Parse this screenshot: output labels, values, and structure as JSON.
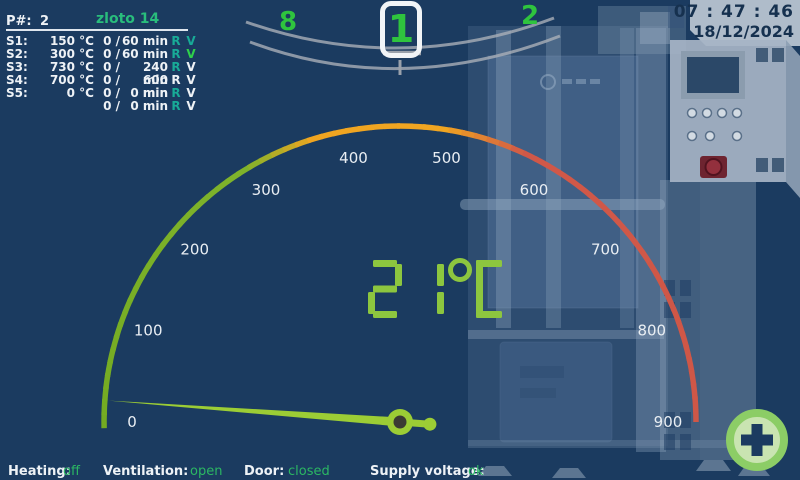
{
  "colors": {
    "background": "#1b3b60",
    "selector_green": "#2fc43e",
    "display_green": "#8dc63f",
    "needle_green": "#9ccd35",
    "needle_hub_dark": "#3b3b33",
    "tick_white": "#e9eef3",
    "clock_navy": "#16314f",
    "status_value_green": "#2bb763",
    "states": {
      "teal": "#18ab97",
      "green": "#2fd14b",
      "white": "#eef2f6"
    }
  },
  "program": {
    "number_label": "P#:",
    "number": "2",
    "name": "zloto 14",
    "r_label": "R",
    "v_label": "V",
    "segments": [
      {
        "id": "S1:",
        "temp": "150 °C",
        "elapsed": "0 /",
        "duration": "60 min",
        "r_state": "teal",
        "v_state": "teal"
      },
      {
        "id": "S2:",
        "temp": "300 °C",
        "elapsed": "0 /",
        "duration": "60 min",
        "r_state": "teal",
        "v_state": "green"
      },
      {
        "id": "S3:",
        "temp": "730 °C",
        "elapsed": "0 /",
        "duration": "240 min",
        "r_state": "teal",
        "v_state": "white"
      },
      {
        "id": "S4:",
        "temp": "700 °C",
        "elapsed": "0 /",
        "duration": "600 min",
        "r_state": "white",
        "v_state": "white"
      },
      {
        "id": "S5:",
        "temp": "0 °C",
        "elapsed": "0 /",
        "duration": "0 min",
        "r_state": "teal",
        "v_state": "white"
      },
      {
        "id": "",
        "temp": "",
        "elapsed": "0 /",
        "duration": "0 min",
        "r_state": "teal",
        "v_state": "white"
      }
    ]
  },
  "program_selector": {
    "prev": "8",
    "current": "1",
    "next": "2"
  },
  "clock": {
    "time": "07 : 47 : 46",
    "date": "18/12/2024"
  },
  "gauge": {
    "type": "gauge",
    "min": 0,
    "max": 900,
    "unit": "°C",
    "value": 21,
    "display": "21",
    "tick_labels": [
      "0",
      "100",
      "200",
      "300",
      "400",
      "500",
      "600",
      "700",
      "800",
      "900"
    ],
    "color_stops": [
      [
        0,
        "#74ab22"
      ],
      [
        0.33,
        "#7fb32b"
      ],
      [
        0.41,
        "#f0a521"
      ],
      [
        0.55,
        "#f0a521"
      ],
      [
        0.64,
        "#d05848"
      ],
      [
        1,
        "#cf5747"
      ]
    ]
  },
  "status_bar": {
    "items": [
      {
        "label": "Heating:",
        "value": "off"
      },
      {
        "label": "Ventilation:",
        "value": "open"
      },
      {
        "label": "Door:",
        "value": "closed"
      },
      {
        "label": "Supply voltage:",
        "value": "ok"
      }
    ]
  },
  "controls": {
    "add_button_icon": "plus-icon"
  }
}
